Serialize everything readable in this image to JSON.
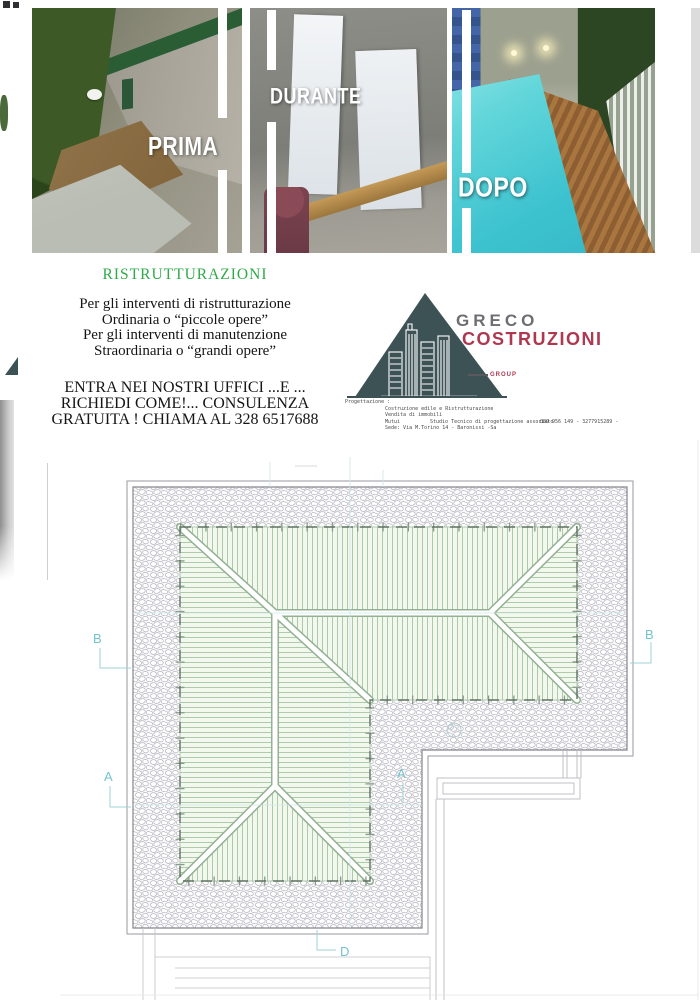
{
  "photos": {
    "before_label": "PRIMA",
    "during_label": "DURANTE",
    "after_label": "DOPO"
  },
  "promo": {
    "heading": "RISTRUTTURAZIONI",
    "heading_color": "#2faa4a",
    "body_lines": [
      "Per gli interventi di ristrutturazione",
      "Ordinaria o “piccole opere”",
      "Per gli interventi di manutenzione",
      "Straordinaria o “grandi opere”"
    ],
    "cta_lines": [
      "ENTRA NEI NOSTRI UFFICI ...E ...",
      "RICHIEDI COME!... CONSULENZA",
      "GRATUITA ! CHIAMA  AL 328 6517688"
    ]
  },
  "logo": {
    "name_line1": "GRECO",
    "name_line2": "COSTRUZIONI",
    "group_label": "GROUP",
    "gray": "#6d6e71",
    "red": "#ad3850",
    "slate": "#3c5254"
  },
  "contact": {
    "label": "Progettazione :",
    "service_1": "Costruzione edile e Ristrutturazione",
    "service_2": "Vendita di immobili",
    "service_3": "Mutui",
    "studio": "Studio Tecnico di progettazione associato",
    "phones": "089 956 149 - 3277915289  -",
    "address": "Sede: Via M.Torino 14 - Baronissi -Sa"
  },
  "plan": {
    "marker_b_left": "B",
    "marker_b_right": "B",
    "marker_a_left": "A",
    "marker_a_inner": "A",
    "marker_d_bottom": "D",
    "marker_color": "#74c4cc",
    "hatch_color": "#a5c6a0",
    "pebble_color": "#b4b4bd",
    "ridge_color": "#93b193"
  }
}
